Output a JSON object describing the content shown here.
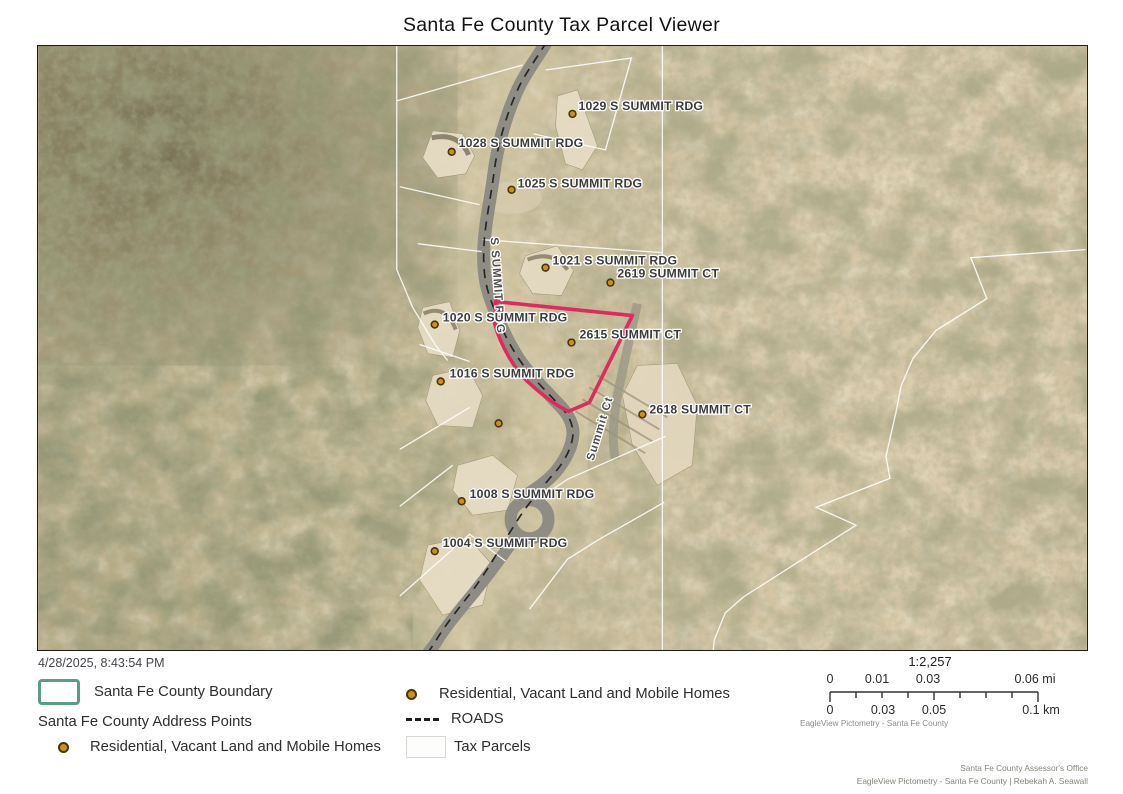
{
  "title": "Santa Fe County Tax Parcel Viewer",
  "timestamp": "4/28/2025, 8:43:54 PM",
  "map": {
    "labels": [
      {
        "text": "1029 S SUMMIT RDG"
      },
      {
        "text": "1028 S SUMMIT RDG"
      },
      {
        "text": "1025 S SUMMIT RDG"
      },
      {
        "text": "1021 S SUMMIT RDG"
      },
      {
        "text": "2619 SUMMIT CT"
      },
      {
        "text": "1020 S SUMMIT RDG"
      },
      {
        "text": "2615 SUMMIT CT"
      },
      {
        "text": "1016 S SUMMIT RDG"
      },
      {
        "text": "2618 SUMMIT CT"
      },
      {
        "text": "1008 S SUMMIT RDG"
      },
      {
        "text": "1004 S SUMMIT RDG"
      }
    ],
    "road_labels": [
      {
        "text": "S SUMMIT RDG"
      },
      {
        "text": "Summit Ct"
      }
    ],
    "colors": {
      "parcel_highlight": "#e02a5e",
      "county_boundary": "#5a9c84",
      "address_point": "#cf9018",
      "parcel_line": "#ffffff"
    }
  },
  "legend": {
    "county_boundary": "Santa Fe County Boundary",
    "address_points_group": "Santa Fe County Address Points",
    "residential_left": "Residential, Vacant Land and Mobile Homes",
    "residential_mid": "Residential, Vacant Land and Mobile Homes",
    "roads": "ROADS",
    "tax_parcels": "Tax Parcels"
  },
  "scalebar": {
    "ratio": "1:2,257",
    "mi_ticks": [
      "0",
      "0.01",
      "0.03",
      "0.06 mi"
    ],
    "km_ticks": [
      "0",
      "0.03",
      "0.05",
      "0.1 km"
    ],
    "source": "EagleView Pictometry - Santa Fe County"
  },
  "credits": {
    "line1": "Santa Fe County Assessor's Office",
    "line2": "EagleView Pictometry - Santa Fe County | Rebekah A. Seawall"
  }
}
